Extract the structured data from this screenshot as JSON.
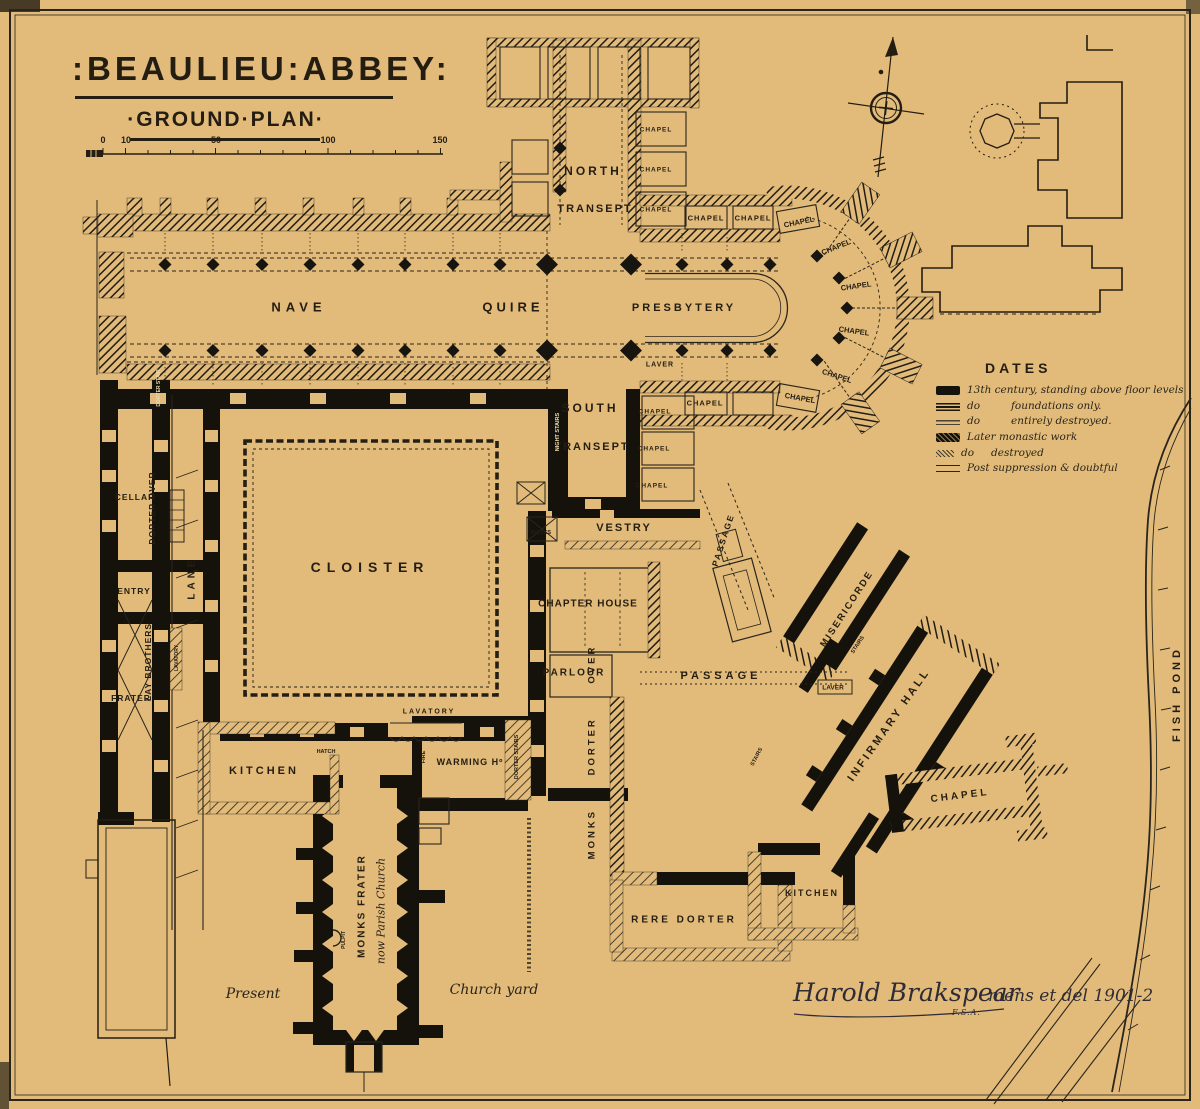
{
  "title": {
    "main": ":BEAULIEU:ABBEY:",
    "subtitle": "·GROUND·PLAN·"
  },
  "scale_bar": {
    "ticks": [
      "0",
      "10",
      "50",
      "100",
      "150"
    ]
  },
  "legend": {
    "heading": "DATES",
    "items": [
      {
        "swatch": "solid-black",
        "prefix": "",
        "text": "13th century, standing above floor levels"
      },
      {
        "swatch": "hatched-dense",
        "prefix": "do",
        "text": "foundations only."
      },
      {
        "swatch": "hatched-light",
        "prefix": "do",
        "text": "entirely destroyed."
      },
      {
        "swatch": "crosshatch",
        "prefix": "",
        "text": "Later monastic work"
      },
      {
        "swatch": "stipple",
        "prefix": "do",
        "text": "destroyed"
      },
      {
        "swatch": "double-line",
        "prefix": "",
        "text": "Post suppression & doubtful"
      }
    ]
  },
  "signature": {
    "name": "Harold Brakspear",
    "credentials": "F.S.A.",
    "note": "mens et del 1901-2"
  },
  "colors": {
    "background": "#e2bb7a",
    "ink": "#2a251c",
    "wall_black": "#15120c",
    "signature_ink": "#2f2c38",
    "reverse_text": "#ecdcae"
  },
  "plan": {
    "labels": [
      {
        "id": "nave",
        "text": "NAVE",
        "x": 299,
        "y": 307,
        "fs": 13,
        "ls": 5
      },
      {
        "id": "quire",
        "text": "QUIRE",
        "x": 513,
        "y": 307,
        "fs": 13,
        "ls": 4
      },
      {
        "id": "presbytery",
        "text": "PRESBYTERY",
        "x": 684,
        "y": 308,
        "fs": 11,
        "ls": 3
      },
      {
        "id": "north-transept-1",
        "text": "NORTH",
        "x": 593,
        "y": 171,
        "fs": 12,
        "ls": 3
      },
      {
        "id": "north-transept-2",
        "text": "TRANSEPT",
        "x": 595,
        "y": 209,
        "fs": 11,
        "ls": 2
      },
      {
        "id": "south-transept-1",
        "text": "SOUTH",
        "x": 590,
        "y": 408,
        "fs": 12,
        "ls": 3
      },
      {
        "id": "south-transept-2",
        "text": "TRANSEPT",
        "x": 592,
        "y": 447,
        "fs": 11,
        "ls": 2
      },
      {
        "id": "vestry",
        "text": "VESTRY",
        "x": 624,
        "y": 528,
        "fs": 11,
        "ls": 2
      },
      {
        "id": "laver-presbytery",
        "text": "LAVER",
        "x": 660,
        "y": 365,
        "fs": 7,
        "ls": 1
      },
      {
        "id": "chapel-nt-1",
        "text": "CHAPEL",
        "x": 656,
        "y": 130,
        "fs": 6.5,
        "ls": 1
      },
      {
        "id": "chapel-nt-2",
        "text": "CHAPEL",
        "x": 656,
        "y": 170,
        "fs": 6.5,
        "ls": 1
      },
      {
        "id": "chapel-nt-3",
        "text": "CHAPEL",
        "x": 656,
        "y": 210,
        "fs": 6.5,
        "ls": 1
      },
      {
        "id": "chapel-n-1",
        "text": "CHAPEL",
        "x": 706,
        "y": 218,
        "fs": 7.5,
        "ls": 1
      },
      {
        "id": "chapel-n-2",
        "text": "CHAPEL",
        "x": 753,
        "y": 218,
        "fs": 7.5,
        "ls": 1
      },
      {
        "id": "chapel-n-3",
        "text": "CHAPEL",
        "x": 799,
        "y": 222,
        "fs": 7.5,
        "rot": -12
      },
      {
        "id": "chapel-arc-1",
        "text": "CHAPEL",
        "x": 836,
        "y": 247,
        "fs": 7.5,
        "rot": -22
      },
      {
        "id": "chapel-arc-2",
        "text": "CHAPEL",
        "x": 856,
        "y": 286,
        "fs": 7.5,
        "rot": -8
      },
      {
        "id": "chapel-arc-3",
        "text": "CHAPEL",
        "x": 854,
        "y": 331,
        "fs": 7.5,
        "rot": 8
      },
      {
        "id": "chapel-arc-4",
        "text": "CHAPEL",
        "x": 837,
        "y": 376,
        "fs": 7.5,
        "rot": 18
      },
      {
        "id": "chapel-s-1",
        "text": "CHAPEL",
        "x": 800,
        "y": 398,
        "fs": 7.5,
        "rot": 10
      },
      {
        "id": "chapel-s-2",
        "text": "CHAPEL",
        "x": 705,
        "y": 403,
        "fs": 7.5,
        "ls": 1
      },
      {
        "id": "chapel-st-1",
        "text": "CHAPEL",
        "x": 655,
        "y": 412,
        "fs": 6.5,
        "ls": 1
      },
      {
        "id": "chapel-st-2",
        "text": "CHAPEL",
        "x": 654,
        "y": 449,
        "fs": 6.5,
        "ls": 1
      },
      {
        "id": "chapel-st-3",
        "text": "CHAPEL",
        "x": 652,
        "y": 486,
        "fs": 6.5,
        "ls": 1
      },
      {
        "id": "night-stairs",
        "text": "NIGHT STAIRS",
        "x": 558,
        "y": 432,
        "fs": 5.5,
        "rot": -90,
        "color": "#ecdcae"
      },
      {
        "id": "books",
        "text": "BOOKS",
        "x": 541,
        "y": 533,
        "fs": 5.5
      },
      {
        "id": "cloister",
        "text": "CLOISTER",
        "x": 370,
        "y": 567,
        "fs": 14,
        "ls": 6
      },
      {
        "id": "chapter-house",
        "text": "CHAPTER HOUSE",
        "x": 588,
        "y": 604,
        "fs": 10,
        "ls": 1
      },
      {
        "id": "parlour",
        "text": "PARLOUR",
        "x": 574,
        "y": 673,
        "fs": 10,
        "ls": 2
      },
      {
        "id": "monks-dorter-over",
        "text": "MONKS DORTER OVER",
        "x": 592,
        "y": 752,
        "fs": 9.5,
        "rot": -90,
        "ls": 3,
        "ws": 28
      },
      {
        "id": "passage-east",
        "text": "PASSAGE",
        "x": 721,
        "y": 676,
        "fs": 11,
        "ls": 4
      },
      {
        "id": "passage-tilted",
        "text": "PASSAGE",
        "x": 723,
        "y": 540,
        "fs": 8.5,
        "rot": -72,
        "ls": 2
      },
      {
        "id": "misericorde",
        "text": "MISERICORDE",
        "x": 847,
        "y": 609,
        "fs": 9.5,
        "rot": -57,
        "ls": 2
      },
      {
        "id": "stairs-misericorde",
        "text": "STAIRS",
        "x": 858,
        "y": 645,
        "fs": 5.5,
        "rot": -57
      },
      {
        "id": "stairs-dorter",
        "text": "STAIRS",
        "x": 757,
        "y": 757,
        "fs": 5.5,
        "rot": -62
      },
      {
        "id": "laver-infirmary",
        "text": "LAVER",
        "x": 833,
        "y": 688,
        "fs": 6.5
      },
      {
        "id": "infirmary-hall",
        "text": "INFIRMARY HALL",
        "x": 889,
        "y": 725,
        "fs": 11,
        "rot": -55,
        "ls": 3
      },
      {
        "id": "infirmary-chapel",
        "text": "CHAPEL",
        "x": 960,
        "y": 796,
        "fs": 10,
        "rot": -7,
        "ls": 3
      },
      {
        "id": "kitchen-infirmary",
        "text": "KITCHEN",
        "x": 812,
        "y": 893,
        "fs": 9,
        "ls": 2
      },
      {
        "id": "rere-dorter",
        "text": "RERE DORTER",
        "x": 684,
        "y": 920,
        "fs": 10,
        "ls": 3
      },
      {
        "id": "warming-house",
        "text": "WARMING Hº",
        "x": 470,
        "y": 762,
        "fs": 9,
        "ls": 1
      },
      {
        "id": "fire",
        "text": "FIRE",
        "x": 424,
        "y": 757,
        "fs": 5.5,
        "rot": -90
      },
      {
        "id": "hatch-label",
        "text": "HATCH",
        "x": 326,
        "y": 752,
        "fs": 5.5
      },
      {
        "id": "lavatory-cloister",
        "text": "LAVATORY",
        "x": 429,
        "y": 712,
        "fs": 7,
        "ls": 2
      },
      {
        "id": "dorter-stairs",
        "text": "DORTER STAIRS",
        "x": 517,
        "y": 757,
        "fs": 5.5,
        "rot": -90
      },
      {
        "id": "kitchen-west",
        "text": "KITCHEN",
        "x": 264,
        "y": 771,
        "fs": 11,
        "ls": 3
      },
      {
        "id": "cellar",
        "text": "CELLAR",
        "x": 135,
        "y": 497,
        "fs": 8.5,
        "ls": 1
      },
      {
        "id": "dorter-over-west",
        "text": "DORTER OVER",
        "x": 152,
        "y": 508,
        "fs": 8.5,
        "rot": -90,
        "ls": 1
      },
      {
        "id": "entry",
        "text": "ENTRY",
        "x": 134,
        "y": 591,
        "fs": 8.5,
        "ls": 1
      },
      {
        "id": "lay-brothers",
        "text": "LAY BROTHERS",
        "x": 148,
        "y": 662,
        "fs": 8.5,
        "rot": -90,
        "ls": 1
      },
      {
        "id": "frater-west",
        "text": "FRATER",
        "x": 131,
        "y": 698,
        "fs": 8.5,
        "ls": 1
      },
      {
        "id": "lane",
        "text": "LANE",
        "x": 192,
        "y": 578,
        "fs": 10,
        "rot": -90,
        "ls": 4
      },
      {
        "id": "lavatory-lane",
        "text": "LAVATORY",
        "x": 177,
        "y": 658,
        "fs": 5,
        "rot": -90
      },
      {
        "id": "dorter-stair-nave",
        "text": "DORTER STAIR",
        "x": 159,
        "y": 388,
        "fs": 5,
        "rot": -90,
        "color": "#ecdcae"
      },
      {
        "id": "monks-frater",
        "text": "MONKS FRATER",
        "x": 362,
        "y": 906,
        "fs": 10,
        "rot": -90,
        "ls": 2
      },
      {
        "id": "parish-church",
        "text": "now Parish Church",
        "x": 381,
        "y": 911,
        "fs": 11,
        "rot": -90,
        "script": true
      },
      {
        "id": "pulpit",
        "text": "PULPIT",
        "x": 344,
        "y": 940,
        "fs": 5,
        "rot": -90
      },
      {
        "id": "present",
        "text": "Present",
        "x": 253,
        "y": 994,
        "fs": 14,
        "script": true
      },
      {
        "id": "church-yard",
        "text": "Church yard",
        "x": 494,
        "y": 990,
        "fs": 14,
        "script": true
      },
      {
        "id": "fish-pond",
        "text": "FISH POND",
        "x": 1177,
        "y": 694,
        "fs": 11,
        "rot": -90,
        "ls": 4
      }
    ]
  }
}
